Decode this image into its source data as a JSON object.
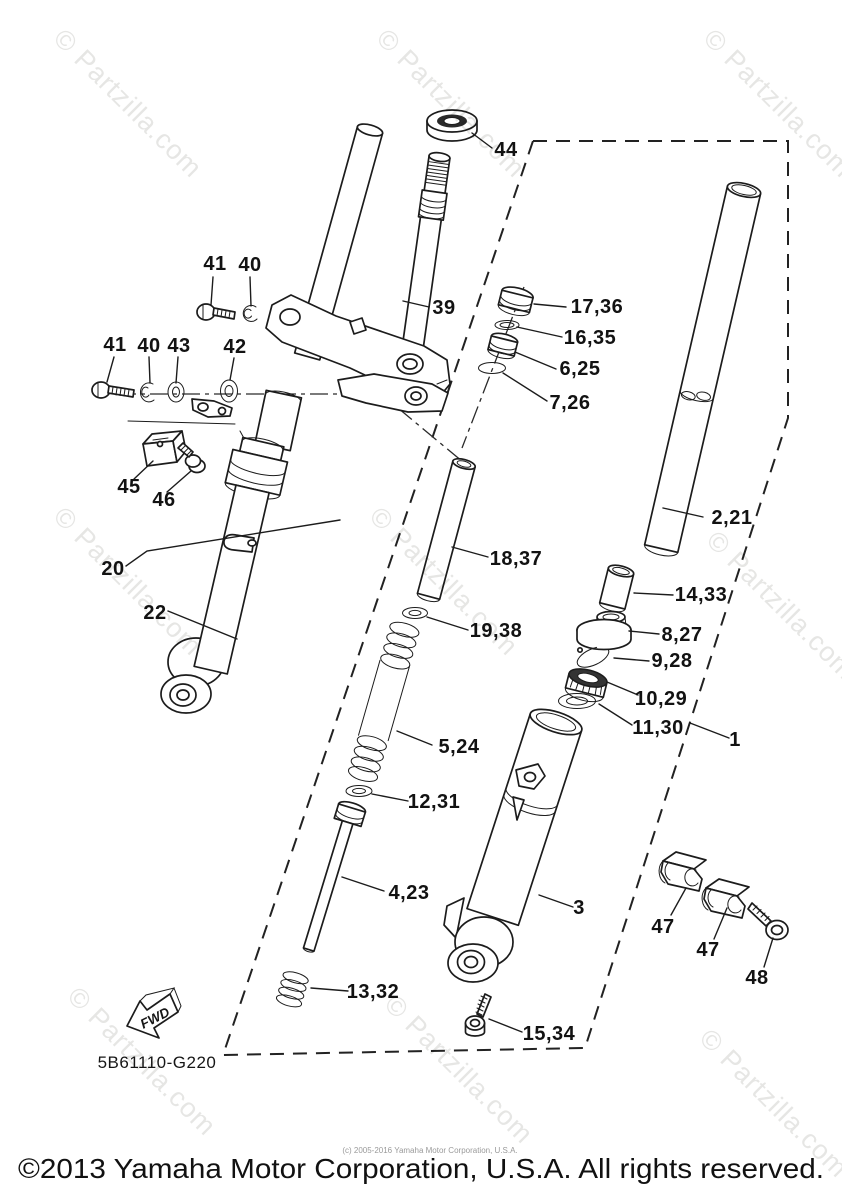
{
  "diagram": {
    "title": "Steering - Front Fork exploded parts diagram",
    "drawing_code": "5B61110-G220",
    "fwd_label": "FWD",
    "watermark": "© Partzilla.com",
    "footer": "©2013 Yamaha Motor Corporation, U.S.A. All rights reserved.",
    "footer_small": "(c) 2005-2016 Yamaha Motor Corporation, U.S.A.",
    "callouts": {
      "c44": "44",
      "c41a": "41",
      "c40a": "40",
      "c41b": "41",
      "c40b": "40",
      "c43": "43",
      "c42": "42",
      "c39": "39",
      "c45": "45",
      "c46": "46",
      "c20": "20",
      "c22": "22",
      "c17_36": "17,36",
      "c16_35": "16,35",
      "c6_25": "6,25",
      "c7_26": "7,26",
      "c18_37": "18,37",
      "c19_38": "19,38",
      "c5_24": "5,24",
      "c12_31": "12,31",
      "c4_23": "4,23",
      "c13_32": "13,32",
      "c15_34": "15,34",
      "c2_21": "2,21",
      "c14_33": "14,33",
      "c8_27": "8,27",
      "c9_28": "9,28",
      "c10_29": "10,29",
      "c11_30": "11,30",
      "c1": "1",
      "c3": "3",
      "c47a": "47",
      "c47b": "47",
      "c48": "48"
    }
  }
}
